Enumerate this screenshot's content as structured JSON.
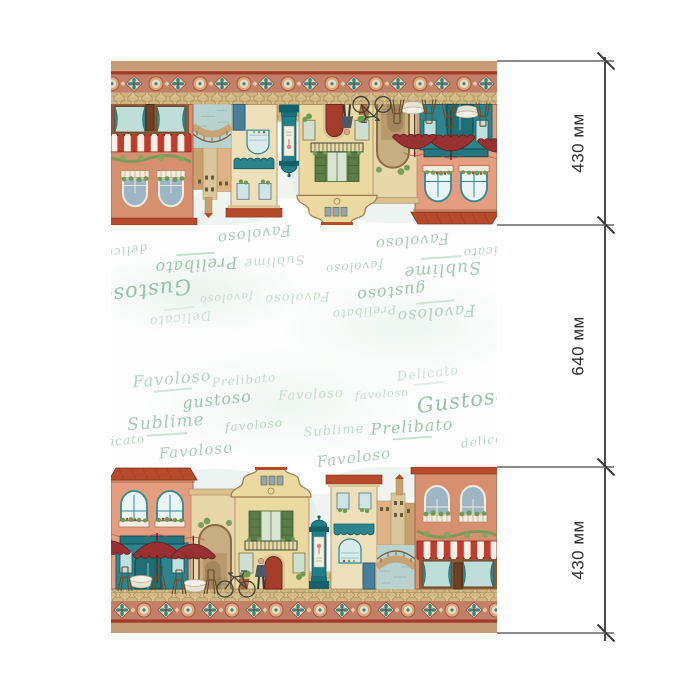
{
  "dimensions": {
    "unit": "мм",
    "segments": [
      {
        "label": "430 мм",
        "value_mm": 430
      },
      {
        "label": "640 мм",
        "value_mm": 640
      },
      {
        "label": "430 мм",
        "value_mm": 430
      }
    ]
  },
  "panel": {
    "palette": {
      "tan_strip": "#c49b75",
      "border_teal": "#2f8a84",
      "border_rust": "#a23b28",
      "roof_red": "#b84a2c",
      "storefront_teal": "#2c858e",
      "wall_salmon": "#e59d80",
      "wall_yellow": "#ebd9a2",
      "wall_terracotta": "#d69070",
      "word_green": "#9cc5ae"
    },
    "words": [
      {
        "text": "Delicato",
        "x": 317,
        "y": 28,
        "size": 13,
        "color": "#cfdfd4",
        "rot": -6,
        "caption": true
      },
      {
        "text": "Favoloso",
        "x": 61,
        "y": 33,
        "size": 16,
        "color": "#b2d1c0",
        "rot": -5,
        "caption": true
      },
      {
        "text": "Prelibato",
        "x": 133,
        "y": 34,
        "size": 12,
        "color": "#c6dccd",
        "rot": -5,
        "caption": false
      },
      {
        "text": "gustoso",
        "x": 106,
        "y": 54,
        "size": 16,
        "color": "#9cc5ae",
        "rot": -6,
        "caption": false
      },
      {
        "text": "Favoloso",
        "x": 200,
        "y": 49,
        "size": 13,
        "color": "#c6dccd",
        "rot": -3,
        "caption": false
      },
      {
        "text": "favoloso",
        "x": 271,
        "y": 48,
        "size": 11,
        "color": "#cadcd0",
        "rot": -4,
        "caption": false
      },
      {
        "text": "Gustoso",
        "x": 352,
        "y": 55,
        "size": 21,
        "color": "#94c2a9",
        "rot": -7,
        "caption": false
      },
      {
        "text": "Sublime",
        "x": 55,
        "y": 77,
        "size": 17,
        "color": "#a6cab7",
        "rot": -4,
        "caption": true
      },
      {
        "text": "favoloso",
        "x": 143,
        "y": 79,
        "size": 12,
        "color": "#b8d4c4",
        "rot": -5,
        "caption": false
      },
      {
        "text": "Sublime",
        "x": 223,
        "y": 85,
        "size": 13,
        "color": "#c6dccd",
        "rot": -4,
        "caption": false
      },
      {
        "text": "Prelibato",
        "x": 301,
        "y": 81,
        "size": 16,
        "color": "#9cc5ae",
        "rot": -4,
        "caption": true
      },
      {
        "text": "delicato",
        "x": 378,
        "y": 94,
        "size": 12,
        "color": "#b8d4c4",
        "rot": -8,
        "caption": false
      },
      {
        "text": "delicato",
        "x": 6,
        "y": 95,
        "size": 12,
        "color": "#b8d4c4",
        "rot": -5,
        "caption": false
      },
      {
        "text": "Favoloso",
        "x": 85,
        "y": 105,
        "size": 15,
        "color": "#accdbb",
        "rot": -5,
        "caption": false
      },
      {
        "text": "Favoloso",
        "x": 243,
        "y": 112,
        "size": 15,
        "color": "#accdbb",
        "rot": -7,
        "caption": false
      }
    ]
  }
}
